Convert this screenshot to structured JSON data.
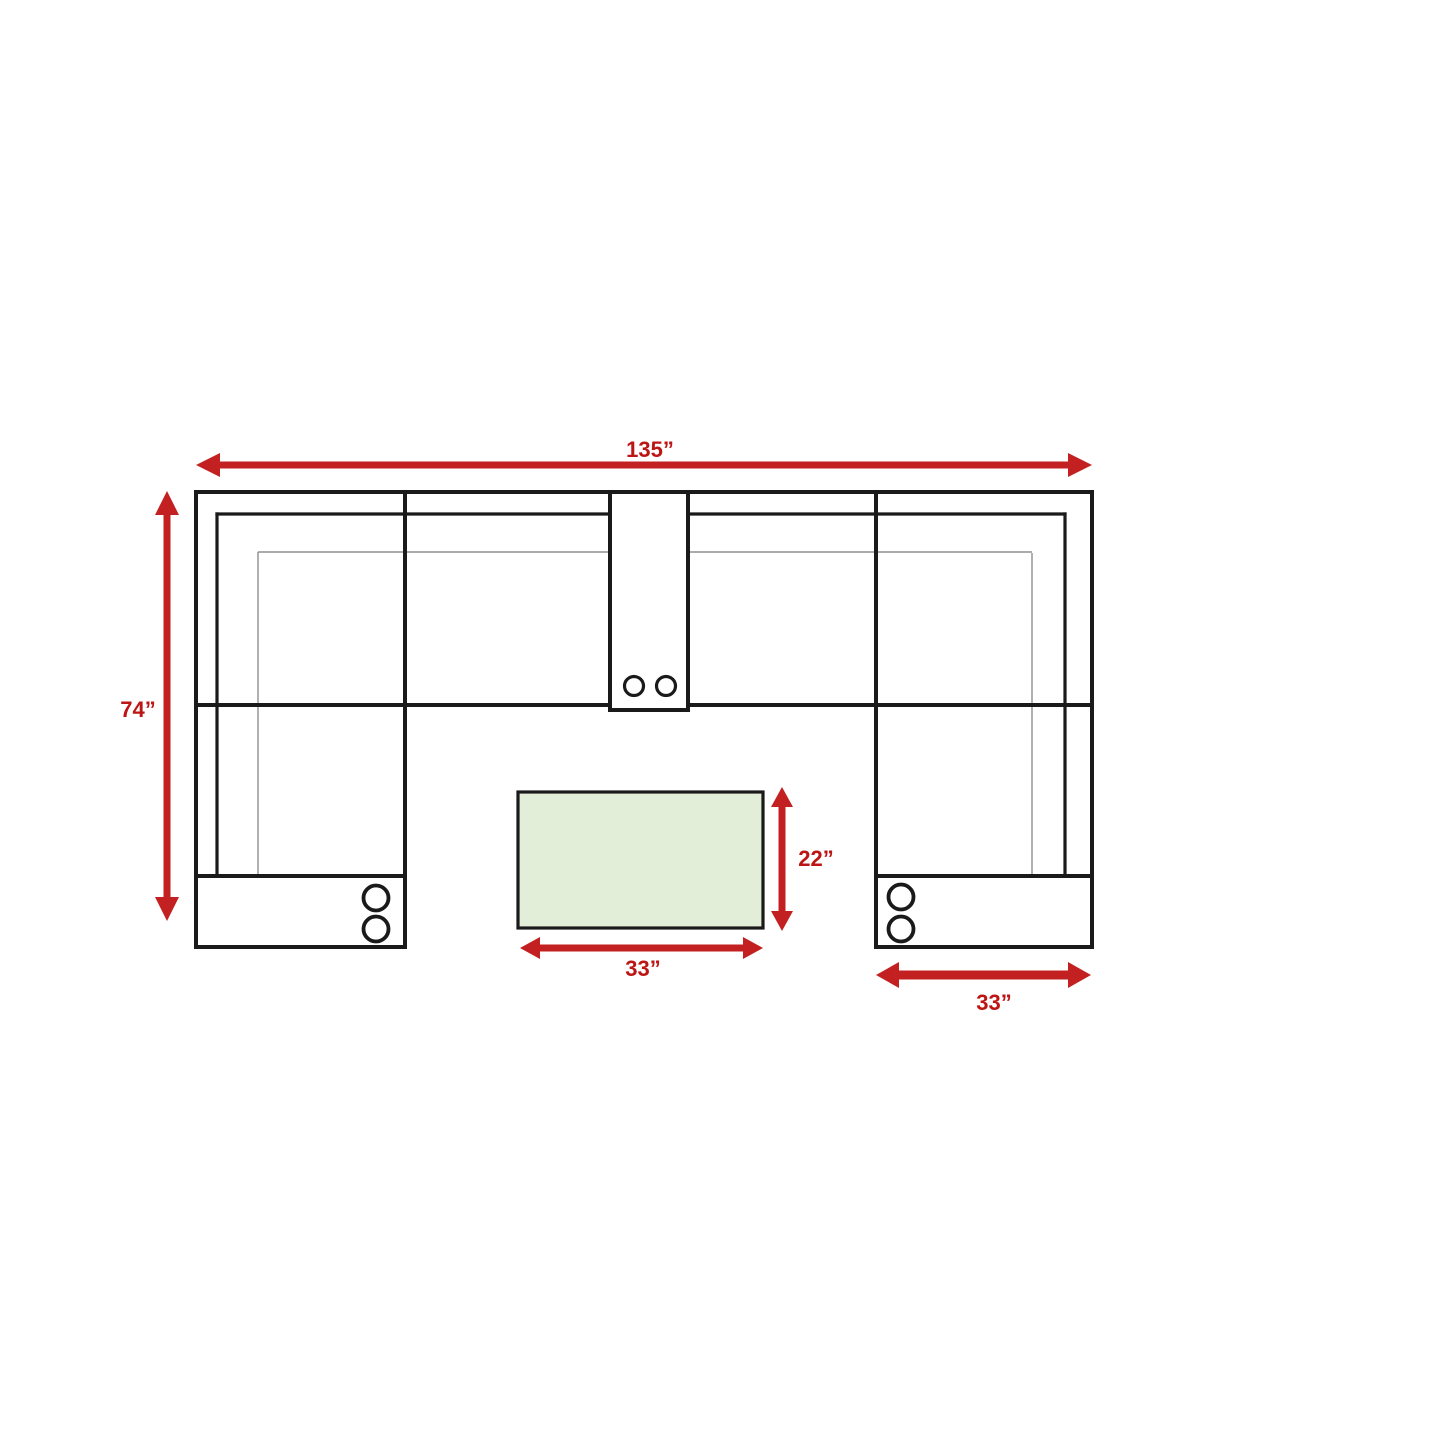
{
  "diagram": {
    "kind": "sectional-sofa-dimension-plan",
    "description": "Top-view line drawing of a U-shaped sectional sofa with a rectangular table, annotated with red dimension arrows"
  },
  "dimension_labels": {
    "overall_width": "135”",
    "overall_depth": "74”",
    "table_depth": "22”",
    "table_width": "33”",
    "chaise_width": "33”"
  },
  "colors": {
    "arrow_red": "#c32121",
    "label_red": "#bd1414",
    "outline_black": "#1a1a1a",
    "thin_line_gray": "#8f8f8f",
    "table_fill_green": "#e2eed7",
    "background_white": "#ffffff"
  },
  "icons": {
    "cupholder": "double-circle",
    "dimension_arrow": "double-headed-arrow"
  }
}
